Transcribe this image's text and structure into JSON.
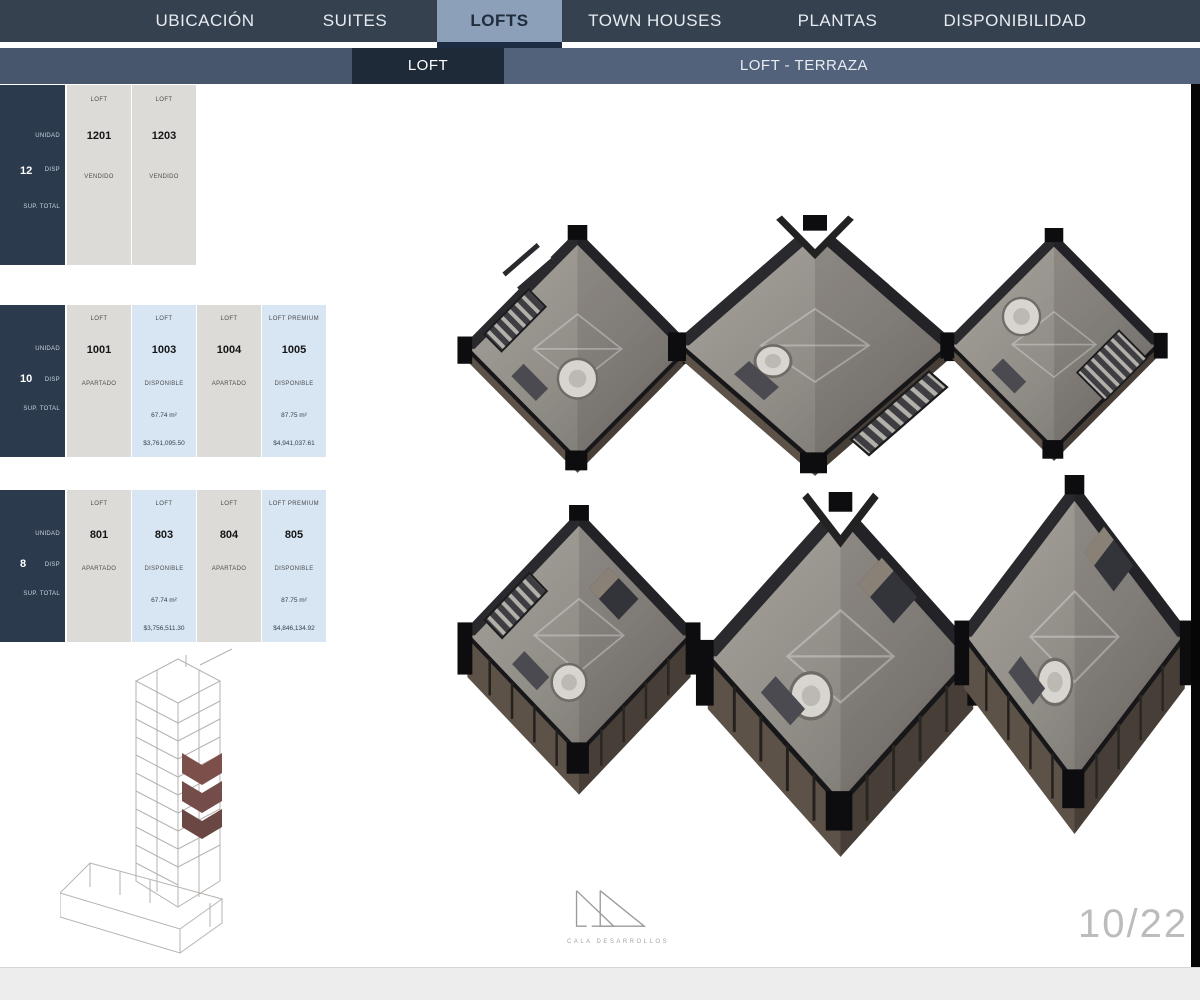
{
  "nav": {
    "active_tab": "LOFTS",
    "tabs": [
      {
        "label": "UBICACIÓN"
      },
      {
        "label": "SUITES"
      },
      {
        "label": "LOFTS"
      },
      {
        "label": "TOWN HOUSES"
      },
      {
        "label": "PLANTAS"
      },
      {
        "label": "DISPONIBILIDAD"
      }
    ]
  },
  "subnav": {
    "active_tab": "LOFT",
    "tabs": [
      {
        "label": "LOFT"
      },
      {
        "label": "LOFT - TERRAZA"
      }
    ]
  },
  "floor_tables": [
    {
      "floor": "12",
      "row_labels": {
        "unit": "UNIDAD",
        "status": "DISP",
        "surface": "SUP. TOTAL"
      },
      "columns": [
        {
          "type": "LOFT",
          "unit": "1201",
          "status": "VENDIDO",
          "area": "",
          "price": ""
        },
        {
          "type": "LOFT",
          "unit": "1203",
          "status": "VENDIDO",
          "area": "",
          "price": ""
        }
      ]
    },
    {
      "floor": "10",
      "row_labels": {
        "unit": "UNIDAD",
        "status": "DISP",
        "surface": "SUP. TOTAL"
      },
      "columns": [
        {
          "type": "LOFT",
          "unit": "1001",
          "status": "APARTADO",
          "area": "",
          "price": ""
        },
        {
          "type": "LOFT",
          "unit": "1003",
          "status": "DISPONIBLE",
          "area": "67.74 m²",
          "price": "$3,761,095.50"
        },
        {
          "type": "LOFT",
          "unit": "1004",
          "status": "APARTADO",
          "area": "",
          "price": ""
        },
        {
          "type": "LOFT PREMIUM",
          "unit": "1005",
          "status": "DISPONIBLE",
          "area": "87.75 m²",
          "price": "$4,941,037.61"
        }
      ]
    },
    {
      "floor": "8",
      "row_labels": {
        "unit": "UNIDAD",
        "status": "DISP",
        "surface": "SUP. TOTAL"
      },
      "columns": [
        {
          "type": "LOFT",
          "unit": "801",
          "status": "APARTADO",
          "area": "",
          "price": ""
        },
        {
          "type": "LOFT",
          "unit": "803",
          "status": "DISPONIBLE",
          "area": "67.74 m²",
          "price": "$3,756,511.30"
        },
        {
          "type": "LOFT",
          "unit": "804",
          "status": "APARTADO",
          "area": "",
          "price": ""
        },
        {
          "type": "LOFT PREMIUM",
          "unit": "805",
          "status": "DISPONIBLE",
          "area": "87.75 m²",
          "price": "$4,846,134.92"
        }
      ]
    }
  ],
  "footer": {
    "page_indicator": "10/22",
    "logo_text": "CALA DESARROLLOS"
  },
  "colors": {
    "nav_bg": "#35414e",
    "active_tab_bg": "#8ca0ba",
    "subnav_bg": "#52627a",
    "subnav_active_bg": "#1f2a38",
    "sidebar_bg": "#2c3a4e",
    "neutral_cell": "#dcdbd8",
    "available_cell": "#d8e6f4",
    "highlighted_floors": "#7d4f4b"
  }
}
